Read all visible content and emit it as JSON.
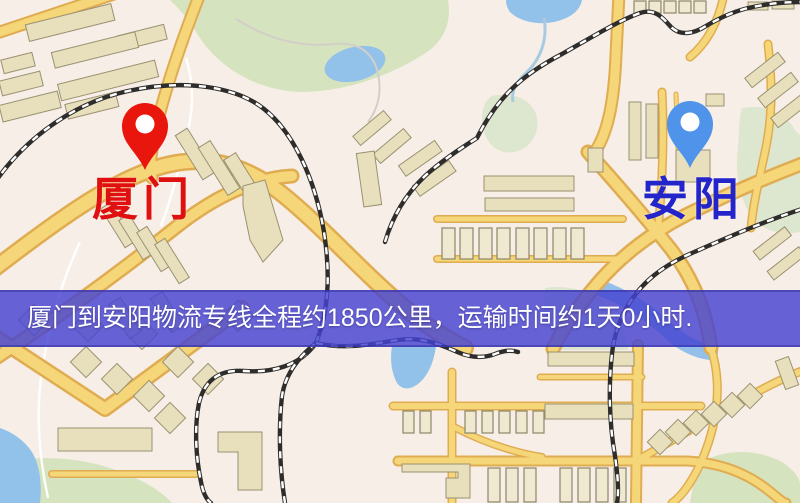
{
  "map": {
    "markers": {
      "origin": {
        "label": "厦门",
        "pin_color": "#e8160c",
        "label_color": "#e01010"
      },
      "destination": {
        "label": "安阳",
        "pin_color": "#4f93ea",
        "label_color": "#2424cb"
      }
    }
  },
  "route": {
    "origin": "厦门",
    "destination": "安阳",
    "distance_text": "约1850公里",
    "duration_text": "约1天0小时",
    "distance_km": 1850,
    "duration_days": 1,
    "duration_hours": 0
  },
  "banner": {
    "text": "厦门到安阳物流专线全程约1850公里，运输时间约1天0小时.",
    "background_color": "#4643d2",
    "text_color": "#ffffff"
  }
}
